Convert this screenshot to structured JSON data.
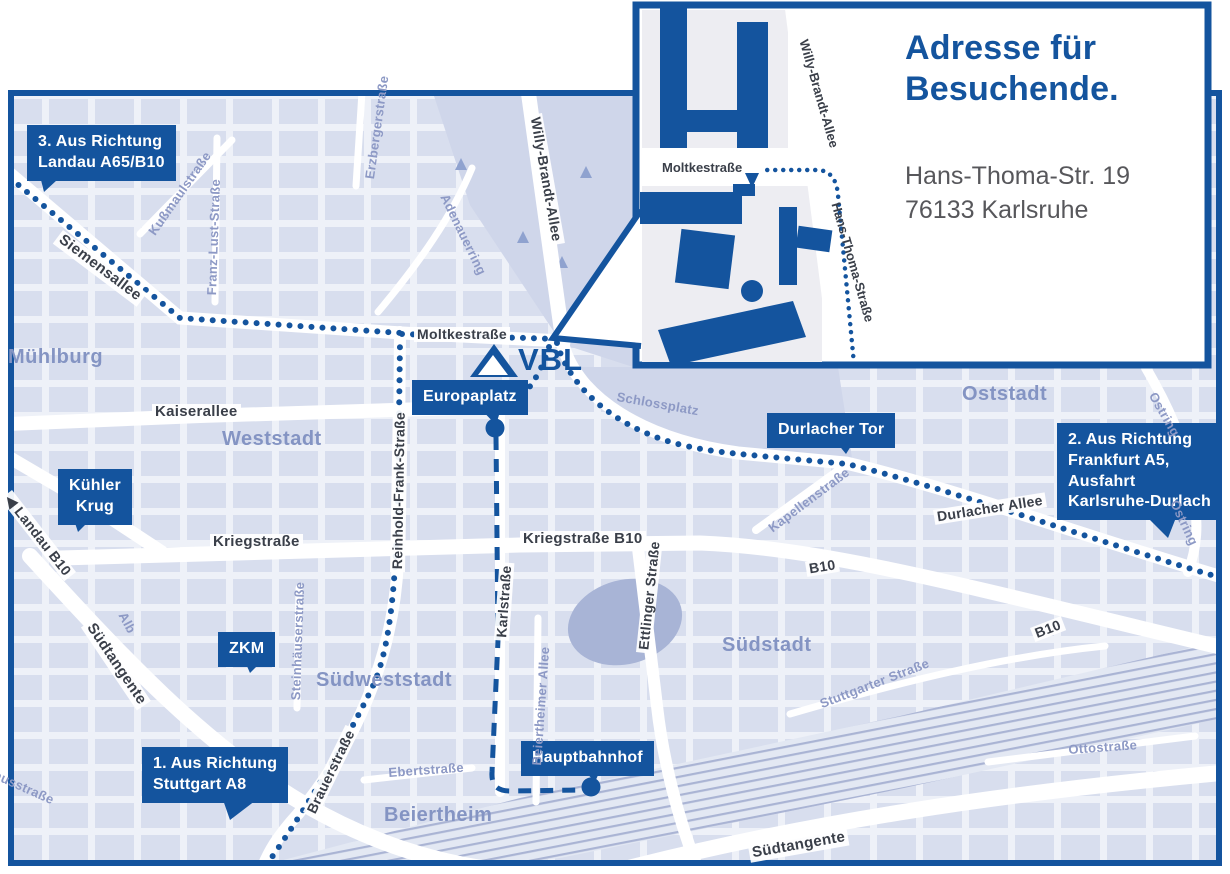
{
  "colors": {
    "brand_blue": "#14549e",
    "map_background": "#eef1f8",
    "block_fill": "#d8deee",
    "park_fill": "#cfd6ea",
    "pond_fill": "#a8b4d6",
    "rail_line": "#aab4d4",
    "street_label": "#3a3f49",
    "minor_label": "#8d99c5",
    "district_label": "#8494c3",
    "address_text": "#57575b"
  },
  "inset": {
    "title": "Adresse für\nBesuchende.",
    "address": "Hans-Thoma-Str. 19\n76133 Karlsruhe",
    "street_moltkestrasse": "Moltkestraße",
    "street_willy_brandt_allee": "Willy-Brandt-Allee",
    "street_hans_thoma_strasse": "Hans-Thoma-Straße"
  },
  "logo": {
    "text": "VBL"
  },
  "callouts": {
    "route3": "3. Aus Richtung\nLandau A65/B10",
    "route2": "2. Aus Richtung\nFrankfurt A5,\nAusfahrt\nKarlsruhe-Durlach",
    "route1": "1. Aus Richtung\nStuttgart A8",
    "europaplatz": "Europaplatz",
    "durlacher_tor": "Durlacher Tor",
    "kuehler_krug": "Kühler\nKrug",
    "zkm": "ZKM",
    "hauptbahnhof": "Hauptbahnhof"
  },
  "districts": {
    "muehlburg": "Mühlburg",
    "weststadt": "Weststadt",
    "oststadt": "Oststadt",
    "suedstadt": "Südstadt",
    "suedweststadt": "Südweststadt",
    "beiertheim": "Beiertheim"
  },
  "streets": {
    "siemensallee": "Siemensallee",
    "moltkestrasse": "Moltkestraße",
    "kaiserallee": "Kaiserallee",
    "kriegstrasse": "Kriegstraße",
    "kriegstrasse_b10": "Kriegstraße B10",
    "reinhold_frank": "Reinhold-Frank-Straße",
    "karlstrasse": "Karlstraße",
    "ettlinger": "Ettlinger Straße",
    "willy_brandt": "Willy-Brandt-Allee",
    "durlacher_allee": "Durlacher Allee",
    "b10_a": "B10",
    "b10_b": "B10",
    "landau_arrow": "◀",
    "landau_b10": "Landau B10",
    "suedtangente_w": "Südtangente",
    "suedtangente_s": "Südtangente",
    "brauerstrasse": "Brauerstraße",
    "ebertstrasse": "Ebertstraße",
    "kussmaulstrasse": "Kußmaulstraße",
    "franz_lust": "Franz-Lust-Straße",
    "erzberger": "Erzbergerstraße",
    "adenauerring": "Adenauerring",
    "schlossplatz": "Schlossplatz",
    "kapellenstrasse": "Kapellenstraße",
    "ostring_a": "Ostring",
    "ostring_b": "Ostring",
    "alb": "Alb",
    "pulverhaus": "Pulverhausstraße",
    "steinhaeuser": "Steinhäuserstraße",
    "beiertheimer_allee": "Beiertheimer Allee",
    "stuttgarter": "Stuttgarter Straße",
    "ottostrasse": "Ottostraße"
  }
}
